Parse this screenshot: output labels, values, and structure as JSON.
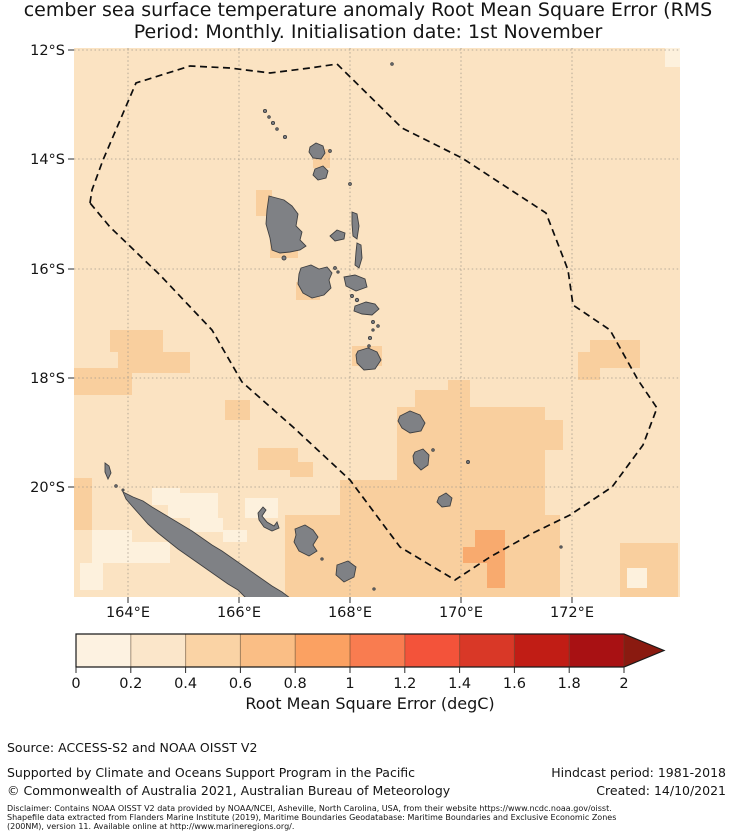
{
  "title": {
    "line1": "cember sea surface temperature anomaly Root Mean Square Error (RMS",
    "line2": "Period: Monthly. Initialisation date: 1st November"
  },
  "map": {
    "lat_ticks": [
      "12°S",
      "14°S",
      "16°S",
      "18°S",
      "20°S"
    ],
    "lon_ticks": [
      "164°E",
      "166°E",
      "168°E",
      "170°E",
      "172°E"
    ],
    "base_color": "#fbe3c2",
    "bin_colors": {
      "0-0.2": "#fdf1dd",
      "0.2-0.4": "#fbe3c2",
      "0.4-0.6": "#f9cf9e",
      "0.6-0.8": "#f8aa6e"
    },
    "land_color": "#7f8185",
    "boundary_style": "black dashed EEZ polygon"
  },
  "colorbar": {
    "label": "Root Mean Square Error (degC)",
    "ticks": [
      "0",
      "0.2",
      "0.4",
      "0.6",
      "0.8",
      "1",
      "1.2",
      "1.4",
      "1.6",
      "1.8",
      "2"
    ],
    "colors": [
      "#fdf2e1",
      "#fbe6ca",
      "#fad3a5",
      "#fabe85",
      "#fba162",
      "#f97c50",
      "#f3533a",
      "#d93827",
      "#c11d15",
      "#a81113"
    ],
    "over_color": "#8a1a10"
  },
  "chart_data": {
    "type": "heatmap",
    "title": "cember sea surface temperature anomaly Root Mean Square Error (RMS",
    "subtitle": "Period: Monthly. Initialisation date: 1st November",
    "colorbar_label": "Root Mean Square Error (degC)",
    "colorbar_ticks": [
      0,
      0.2,
      0.4,
      0.6,
      0.8,
      1,
      1.2,
      1.4,
      1.6,
      1.8,
      2
    ],
    "colorbar_extends_beyond": 2,
    "lat_ticks_deg_S": [
      12,
      14,
      16,
      18,
      20
    ],
    "lon_ticks_deg_E": [
      164,
      166,
      168,
      170,
      172
    ],
    "approx_domain": {
      "lat_S": [
        12,
        22
      ],
      "lon_E": [
        163,
        174
      ]
    },
    "value_summary": "Most of the domain is in the 0.2-0.4 degC bin; 0.4-0.6 degC patches west of 166E near 18S, southeast of Vanuatu (168-172.5E, 19-22S), around island coasts (Vanua Lava, Espiritu Santo, Malakula, Efate, Tanna) and near 172.5E 17.5S; a small 0.6-0.8 degC patch near 170.5E 21.5S; scattered 0-0.2 degC cells around New Caledonia, the far NE corner and SE corner.",
    "overlays": [
      "dashed EEZ boundary polygon",
      "gray land: Vanuatu archipelago, New Caledonia, Loyalty Islands"
    ]
  },
  "footer": {
    "source": "Source: ACCESS-S2 and NOAA OISST V2",
    "supported": "Supported by Climate and Oceans Support Program in the Pacific",
    "hindcast": "Hindcast period: 1981-2018",
    "copyright": "© Commonwealth of Australia 2021, Australian Bureau of Meteorology",
    "created": "Created: 14/10/2021",
    "disclaimer": [
      "Disclaimer: Contains NOAA OISST V2 data provided by NOAA/NCEI, Asheville, North Carolina, USA, from their website https://www.ncdc.noaa.gov/oisst.",
      "Shapefile data extracted from Flanders Marine Institute (2019), Maritime Boundaries Geodatabase: Maritime Boundaries and Exclusive Economic Zones",
      "(200NM), version 11. Available online at http://www.marineregions.org/."
    ]
  }
}
